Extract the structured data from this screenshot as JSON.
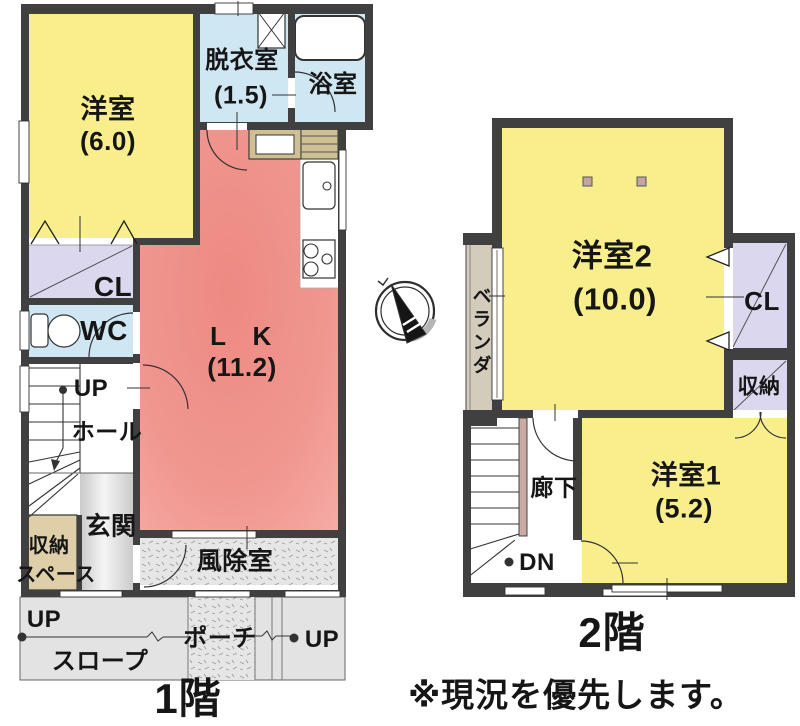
{
  "floor1": {
    "title": "1階",
    "rooms": {
      "yoshitsu": {
        "name": "洋室",
        "size": "(6.0)"
      },
      "datsui": {
        "name": "脱衣室",
        "size": "(1.5)"
      },
      "yokushitsu": {
        "name": "浴室"
      },
      "cl": {
        "name": "CL"
      },
      "wc": {
        "name": "WC"
      },
      "stairs_up": {
        "name": "UP"
      },
      "hall": {
        "name": "ホール"
      },
      "lk": {
        "name": "L　K",
        "size": "(11.2)"
      },
      "genkan": {
        "name": "玄関"
      },
      "shuno_space": {
        "line1": "収納",
        "line2": "スペース"
      },
      "fujoshitsu": {
        "name": "風除室"
      },
      "slope_up": {
        "name": "UP"
      },
      "slope": {
        "name": "スロープ"
      },
      "porch": {
        "name": "ポーチ"
      },
      "porch_up": {
        "name": "UP"
      }
    }
  },
  "floor2": {
    "title": "2階",
    "rooms": {
      "yoshitsu2": {
        "name": "洋室2",
        "size": "(10.0)"
      },
      "veranda": {
        "name": "ベランダ"
      },
      "cl": {
        "name": "CL"
      },
      "shuno": {
        "name": "収納"
      },
      "roka": {
        "name": "廊下"
      },
      "stairs_dn": {
        "name": "DN"
      },
      "yoshitsu1": {
        "name": "洋室1",
        "size": "(5.2)"
      }
    }
  },
  "note": "※現況を優先します。",
  "icons": {
    "compass": "compass-north-icon"
  },
  "colors": {
    "wall": "#404040",
    "room_yellow": "#f8ee8c",
    "room_pink_dark": "#ee8b83",
    "room_pink_light": "#f6aea7",
    "room_blue": "#cfe6f3",
    "closet_purple": "#dbd7ee",
    "storage_tan": "#decfa8",
    "veranda_tan": "#d4ccba",
    "counter_tan": "#cfc093",
    "entrance_gray": "#e2e2e2",
    "texture_gray": "#e6e6e6",
    "slope_gray": "#e3e3e3",
    "handrail_pink": "#c9aba3"
  }
}
